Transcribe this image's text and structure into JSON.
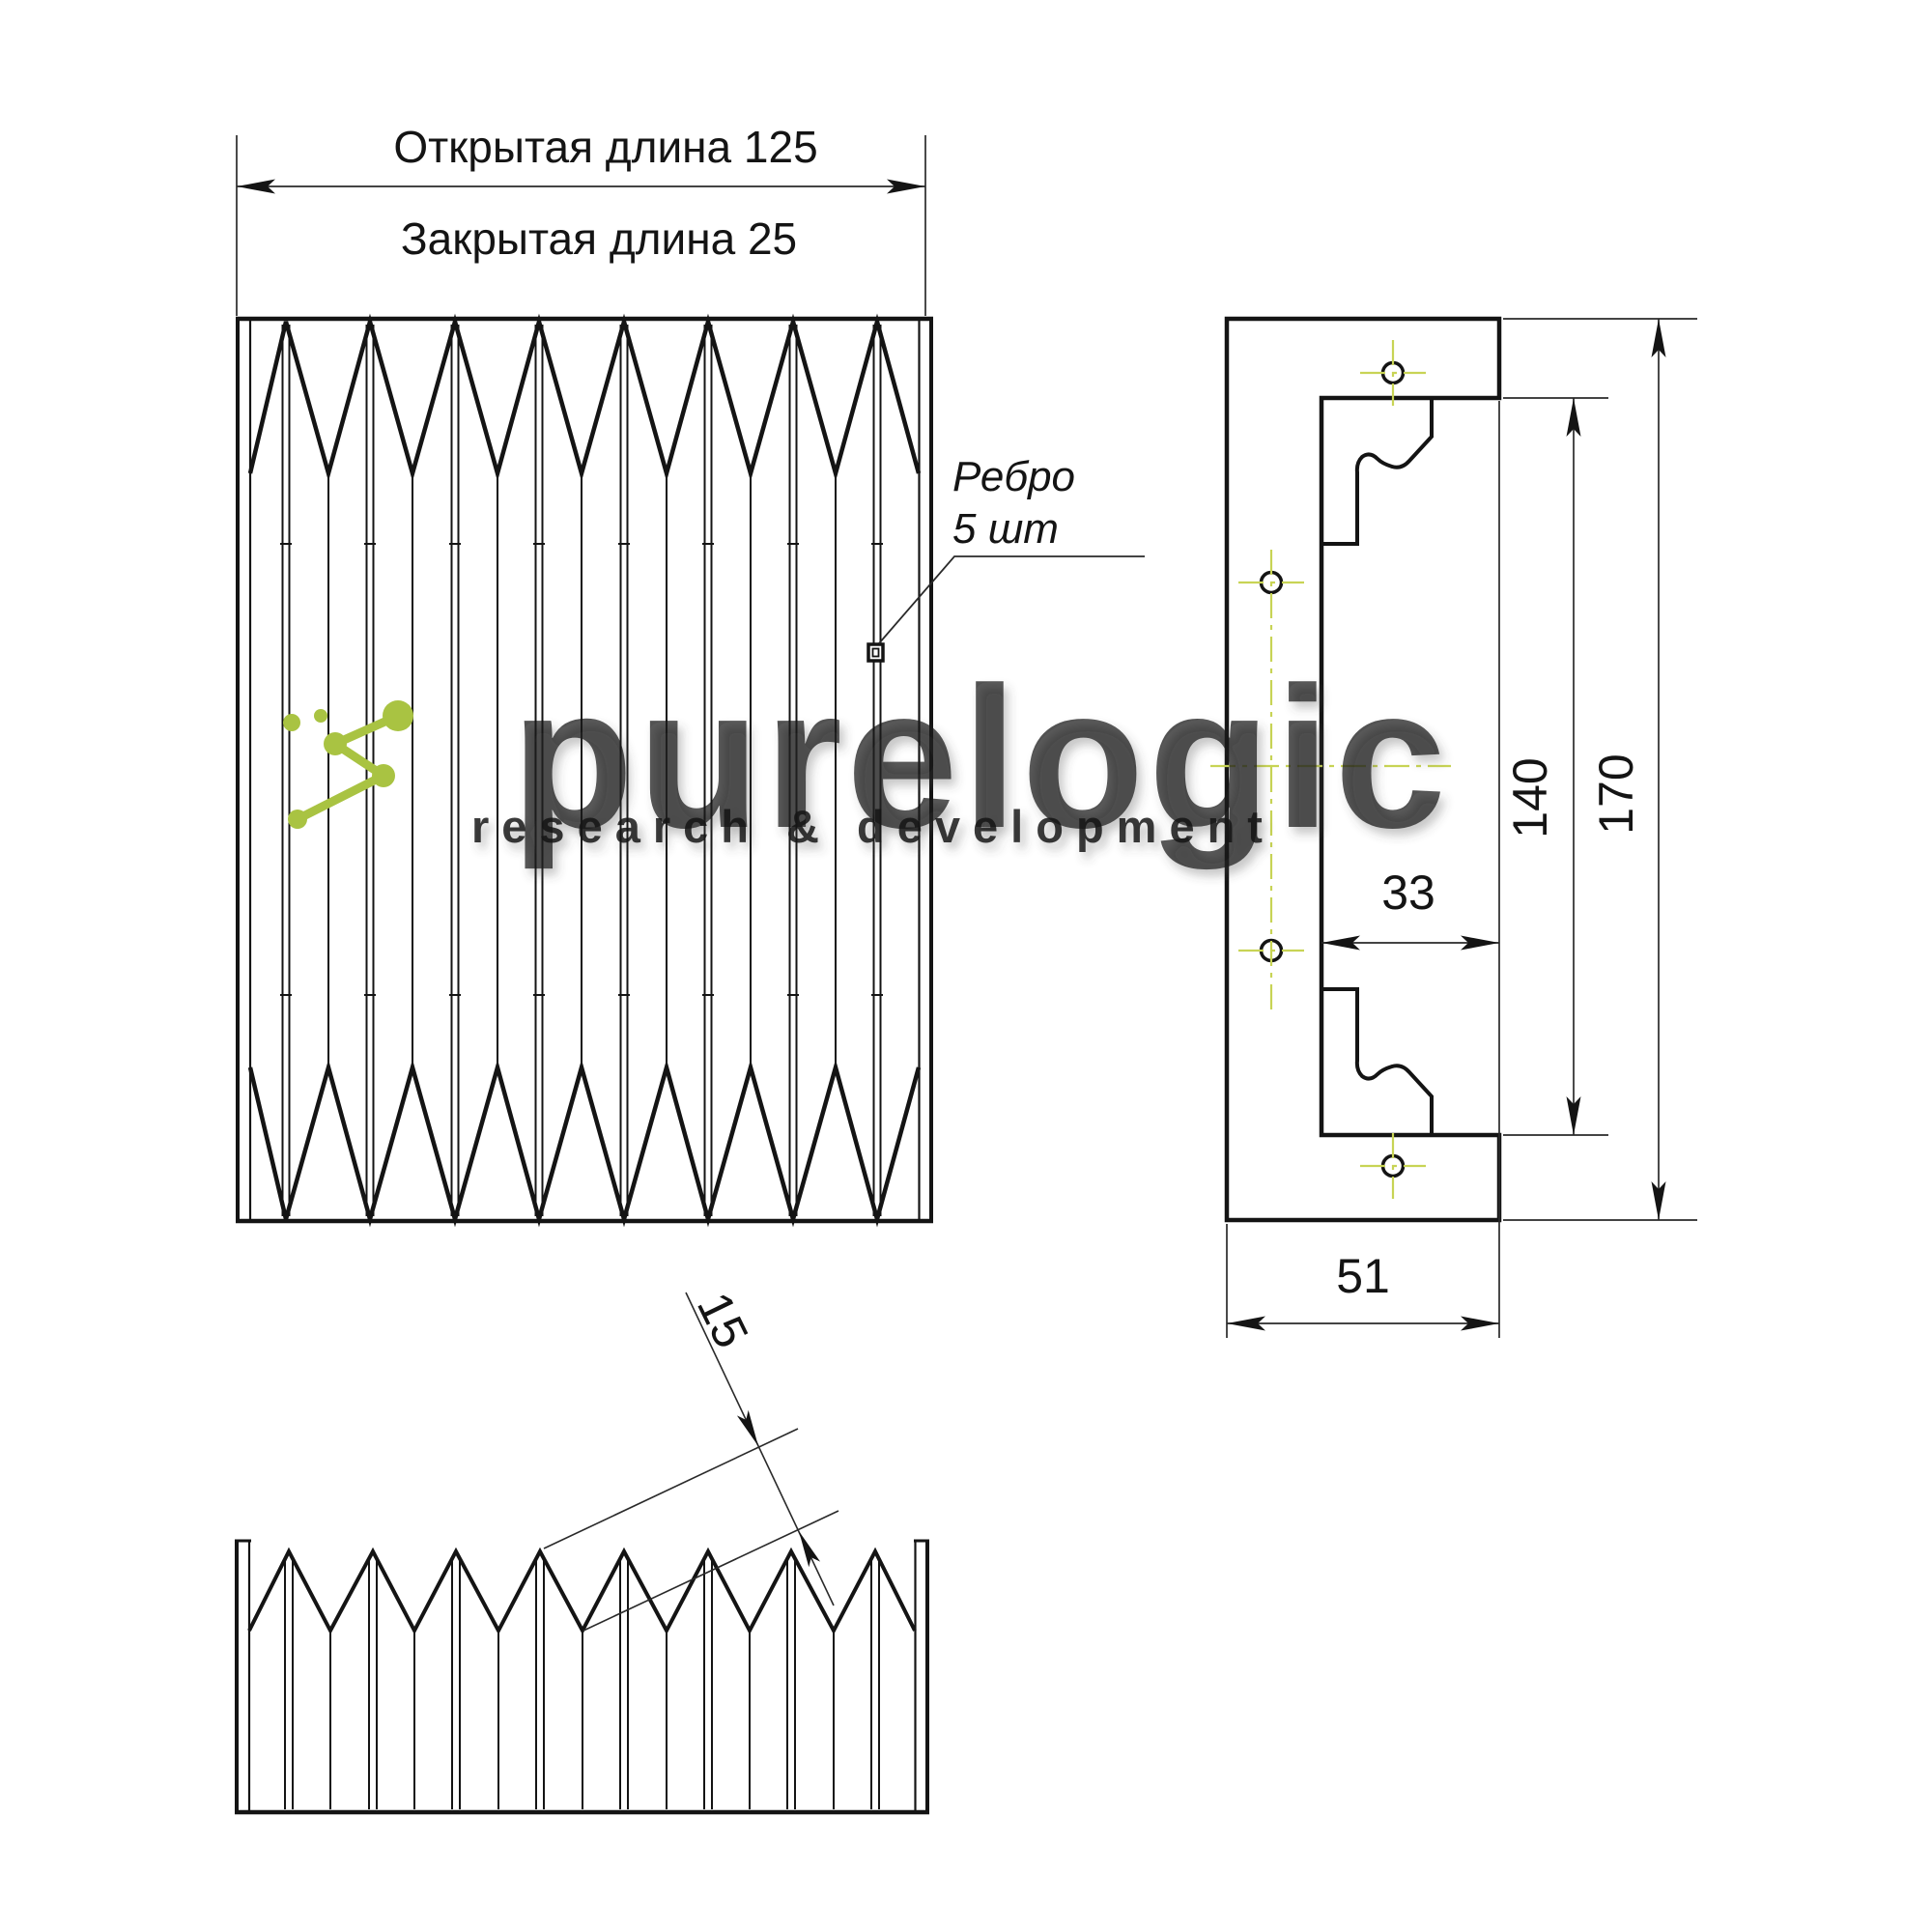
{
  "labels": {
    "open_length": "Открытая длина 125",
    "closed_length": "Закрытая длина 25",
    "rib_line1": "Ребро",
    "rib_line2": "5 шт"
  },
  "dimensions": {
    "height_inner": "140",
    "height_outer": "170",
    "width_inner": "33",
    "width_outer": "51",
    "fold_pitch": "15"
  },
  "watermark": {
    "brand": "purelogic",
    "tagline": "research & development",
    "accent_color": "#a9c342",
    "brand_color": "#ffffff",
    "tagline_color": "#bfbfbf"
  },
  "style": {
    "line_color": "#141414",
    "centerline_color": "#c8d455",
    "background": "#ffffff"
  }
}
